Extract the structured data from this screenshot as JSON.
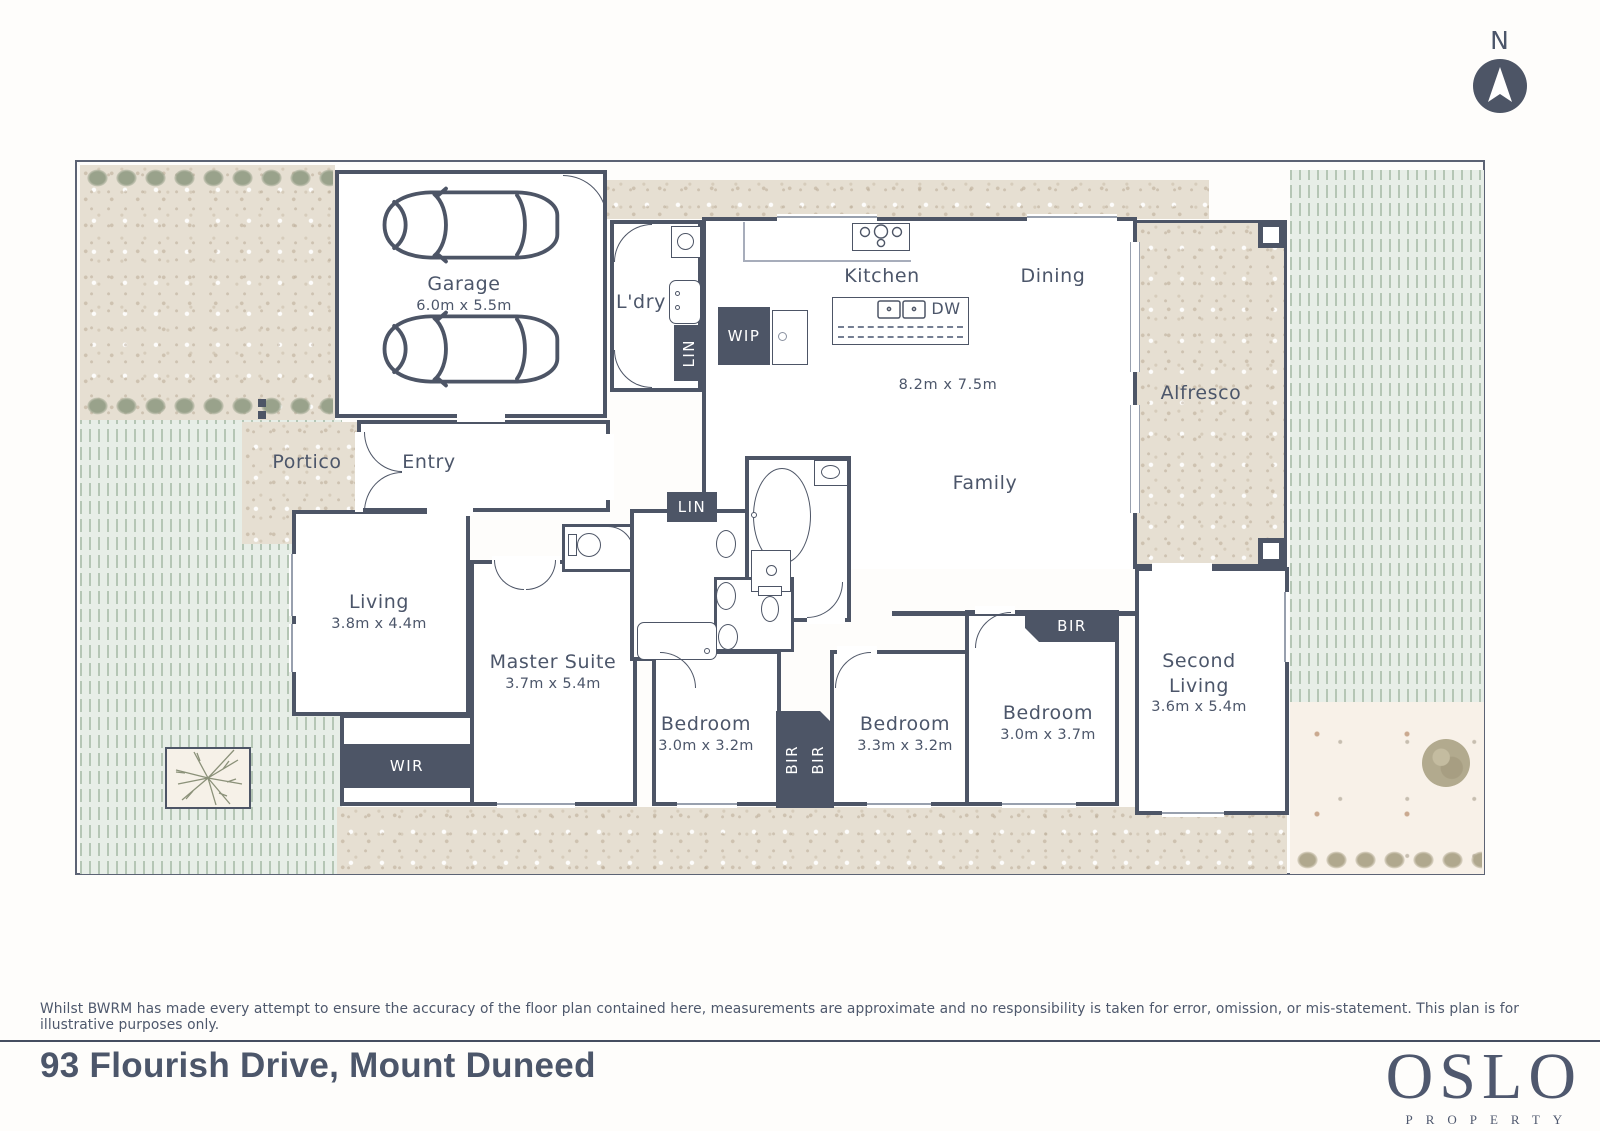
{
  "compass": {
    "label": "N"
  },
  "plan": {
    "garage": {
      "name": "Garage",
      "dims": "6.0m x 5.5m"
    },
    "ldry": {
      "name": "L'dry"
    },
    "kitchen": {
      "name": "Kitchen"
    },
    "dining": {
      "name": "Dining"
    },
    "dw": "DW",
    "open_dims": "8.2m x 7.5m",
    "family": {
      "name": "Family"
    },
    "alfresco": {
      "name": "Alfresco"
    },
    "portico": {
      "name": "Portico"
    },
    "entry": {
      "name": "Entry"
    },
    "living": {
      "name": "Living",
      "dims": "3.8m x 4.4m"
    },
    "master": {
      "name": "Master Suite",
      "dims": "3.7m x 5.4m"
    },
    "wir": "WIR",
    "wip": "WIP",
    "lin": "LIN",
    "bir": "BIR",
    "bedroom2": {
      "name": "Bedroom",
      "dims": "3.0m x 3.2m"
    },
    "bedroom3": {
      "name": "Bedroom",
      "dims": "3.3m x 3.2m"
    },
    "bedroom4": {
      "name": "Bedroom",
      "dims": "3.0m x 3.7m"
    },
    "second_living": {
      "name": "Second Living",
      "dims": "3.6m x 5.4m"
    }
  },
  "footer": {
    "disclaimer": "Whilst BWRM  has made every attempt to ensure the accuracy of the floor plan contained here, measurements are approximate and no responsibility is taken for error, omission, or mis-statement. This plan is for illustrative purposes only.",
    "address": "93 Flourish Drive, Mount Duneed",
    "brand": "OSLO",
    "brand_tagline": "PROPERTY"
  },
  "colors": {
    "wall": "#4d5566",
    "label": "#4c566a",
    "lawn": "#e7eee7",
    "concrete": "#e6dfd2"
  }
}
